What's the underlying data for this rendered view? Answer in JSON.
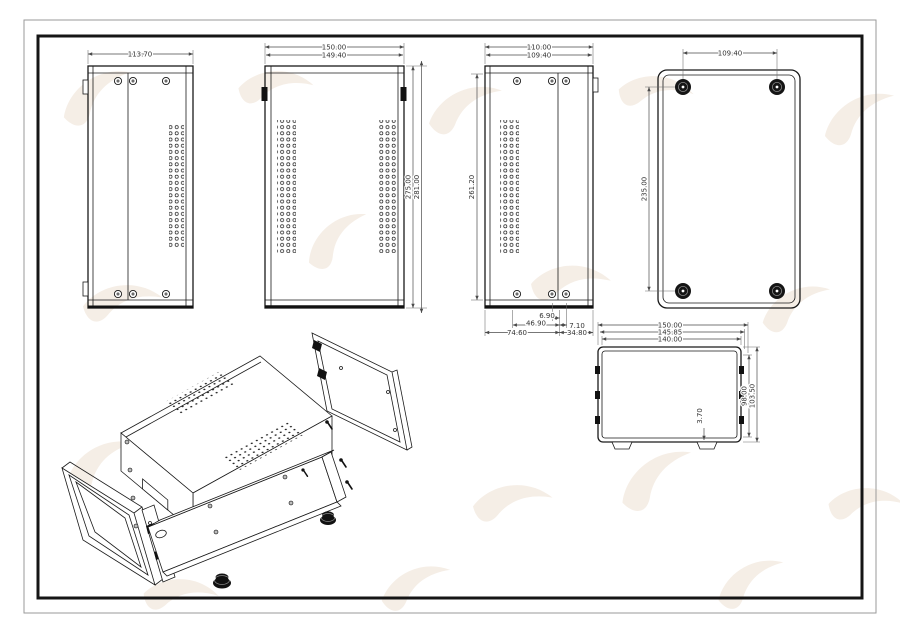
{
  "document": {
    "sheet_label": "sheet-metal enclosure technical drawing",
    "views": {
      "side_panel_a": {
        "title": "left side panel view",
        "width": "113.70"
      },
      "cover_top": {
        "title": "top cover view",
        "width_outer": "150.00",
        "width_inner": "149.40",
        "height_inner": "275.00",
        "height_outer": "281.00"
      },
      "side_panel_b": {
        "title": "right side panel view",
        "width_outer": "110.00",
        "width_inner": "109.40",
        "height": "261.20",
        "bottom_dims": {
          "d1": "6.90",
          "d2": "46.90",
          "d3": "7.10",
          "d4": "74.60",
          "d5": "34.80"
        }
      },
      "bottom_feet": {
        "title": "bottom view with feet",
        "feet_spacing_w": "109.40",
        "feet_spacing_h": "235.00"
      },
      "front": {
        "title": "front view",
        "width_1": "150.00",
        "width_2": "145.85",
        "width_3": "140.00",
        "height_1": "98.00",
        "height_2": "103.50",
        "wall": "3.70"
      },
      "isometric": {
        "title": "exploded isometric view"
      }
    },
    "colors": {
      "line": "#1a1a1a",
      "dim_line": "#4a4a4a",
      "watermark": "#f2e8de",
      "background": "#ffffff"
    }
  }
}
